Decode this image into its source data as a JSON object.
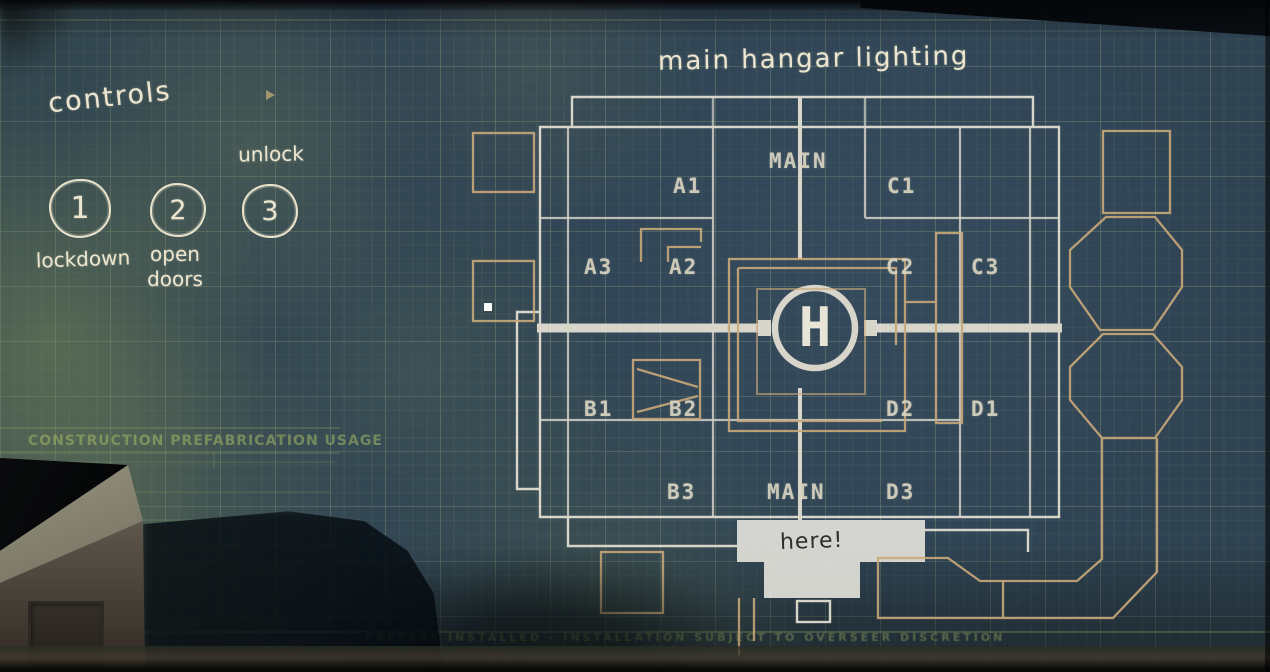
{
  "map": {
    "title": "main hangar lighting",
    "helipad_label": "H",
    "here_note": "here!",
    "zone_labels": {
      "main_top": "MAIN",
      "a1": "A1",
      "c1": "C1",
      "a3": "A3",
      "a2": "A2",
      "c2": "C2",
      "c3": "C3",
      "b1": "B1",
      "b2": "B2",
      "d2": "D2",
      "d1": "D1",
      "b3": "B3",
      "main_bottom": "MAIN",
      "d3": "D3"
    }
  },
  "controls": {
    "title": "controls",
    "buttons": [
      {
        "number": "1",
        "label": "lockdown"
      },
      {
        "number": "2",
        "label": "open doors"
      },
      {
        "number": "3",
        "label": "unlock"
      }
    ]
  },
  "wall_text": {
    "construction_header": "CONSTRUCTION PREFABRICATION USAGE",
    "bottom_note": "PREFABS INSTALLED - INSTALLATION SUBJECT TO OVERSEER DISCRETION"
  },
  "colors": {
    "wall_base": "#2f4353",
    "stain_green": "#8a9a5c",
    "line_white": "#e6e2d4",
    "line_tan": "#c9a87a",
    "chalk": "#ece6cf",
    "patch": "#e9e7e0",
    "ink": "#2f2d27"
  }
}
